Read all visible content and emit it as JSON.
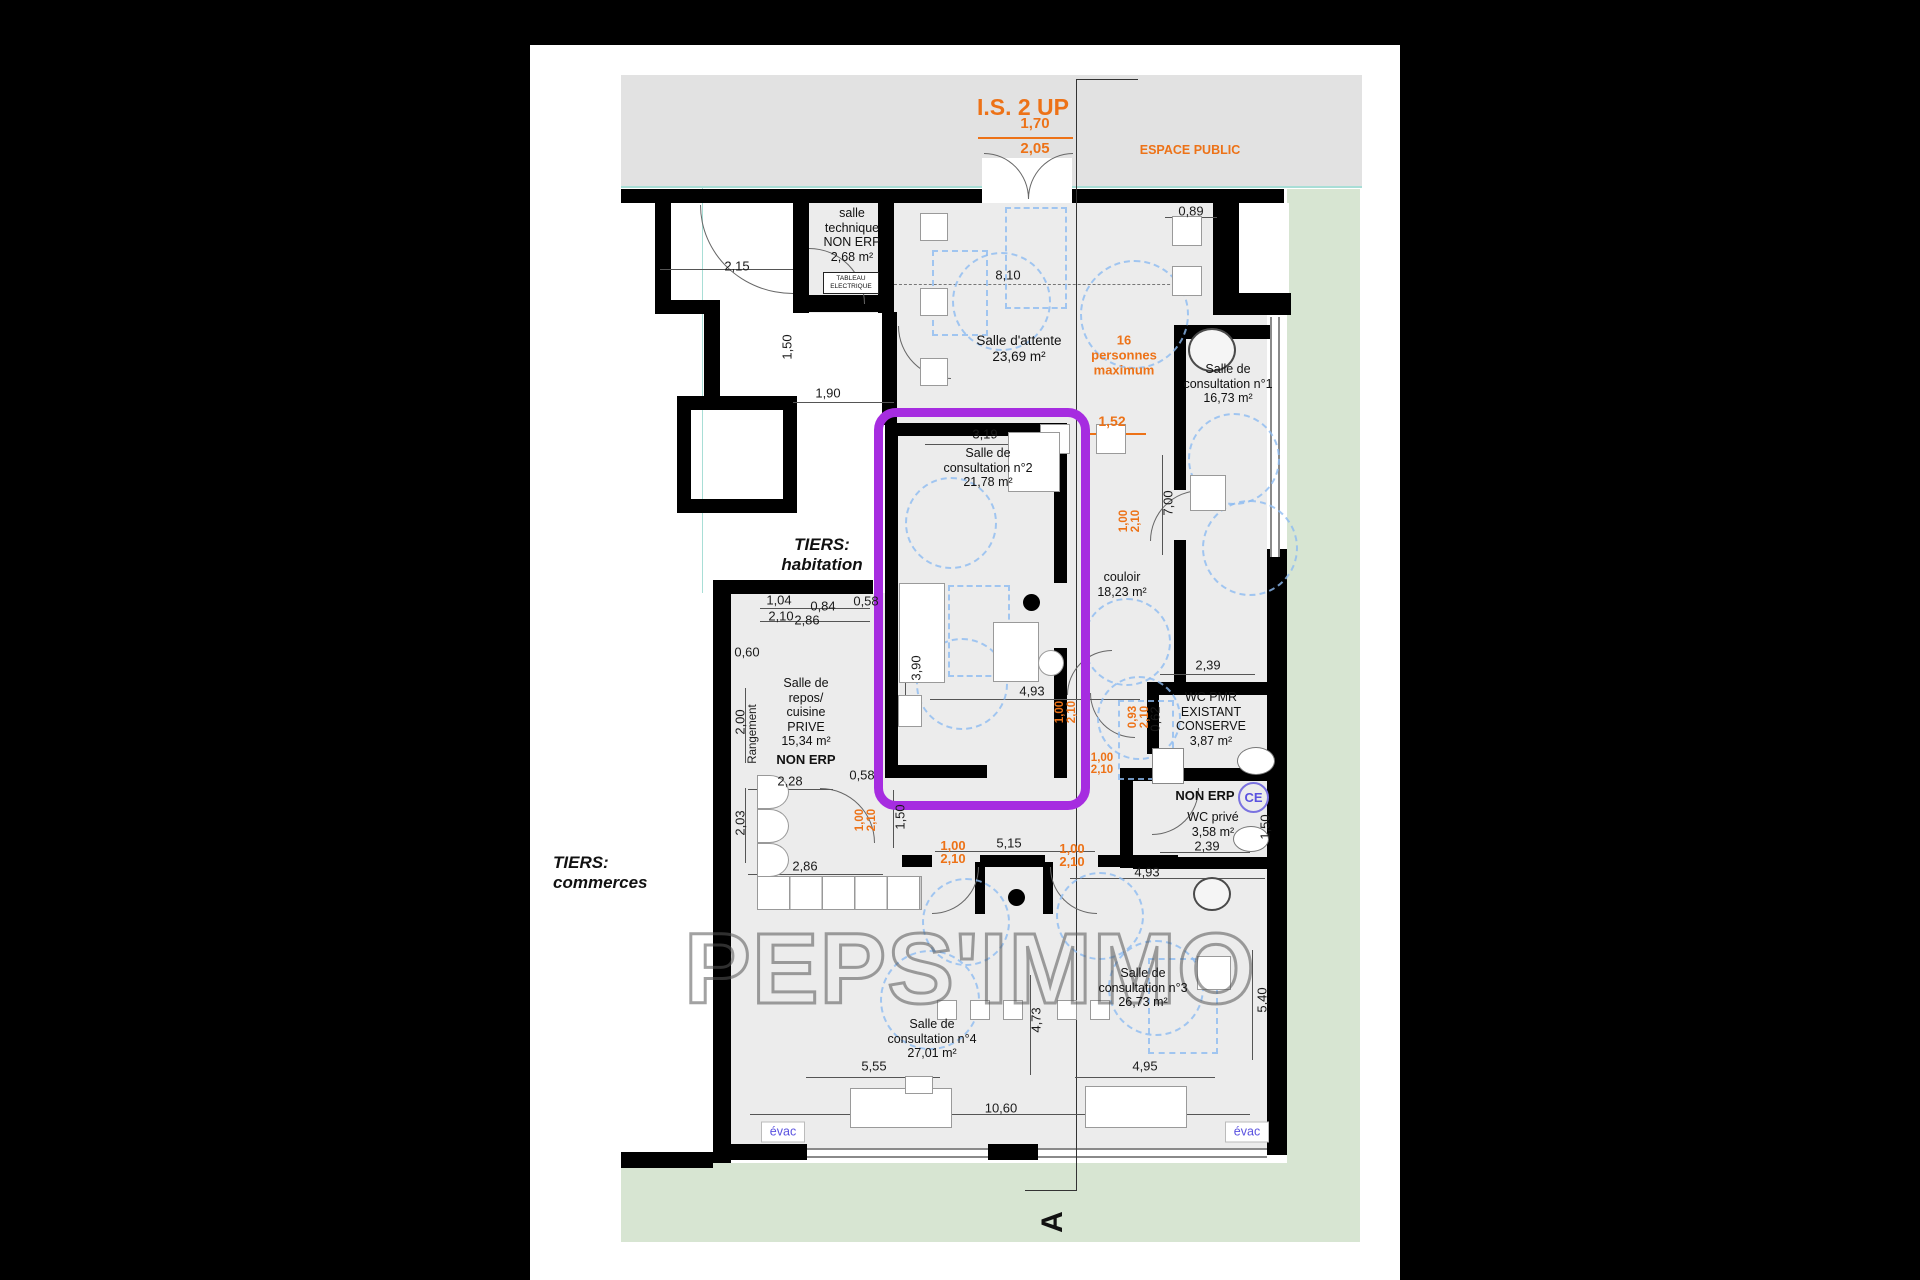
{
  "plan": {
    "watermark": "PEPS'IMMO",
    "public_space": {
      "exit_label": "I.S. 2 UP",
      "exit_width": "1,70",
      "exit_height": "2,05",
      "zone_label": "ESPACE PUBLIC"
    },
    "occupancy_note": "16\npersonnes\nmaximum",
    "section_marker": "A",
    "rooms": {
      "technique": "salle\ntechnique\nNON ERP\n2,68 m²",
      "tableau": "TABLEAU\nELECTRIQUE",
      "attente": "Salle d'attente\n23,69 m²",
      "consult1": "Salle de\nconsultation n°1\n16,73 m²",
      "consult2": "Salle de\nconsultation n°2\n21,78 m²",
      "couloir": "couloir\n18,23 m²",
      "repos": "Salle de\nrepos/\ncuisine\nPRIVE\n15,34 m²",
      "repos_non_erp": "NON ERP",
      "rangement": "Rangement",
      "wc_pmr": "WC PMR\nEXISTANT\nCONSERVE\n3,87 m²",
      "wc_prive_non_erp": "NON ERP",
      "ce_badge": "CE",
      "wc_prive": "WC privé\n3,58 m²",
      "consult3": "Salle de\nconsultation n°3\n26,73 m²",
      "consult4": "Salle de\nconsultation n°4\n27,01 m²",
      "tiers_habitation": "TIERS:\nhabitation",
      "tiers_commerces": "TIERS:\ncommerces",
      "evac": "évac"
    },
    "dims_black": [
      "0,89",
      "2,15",
      "8,10",
      "1,50",
      "1,90",
      "3,19",
      "7,00",
      "0,58",
      "1,04",
      "0,84",
      "2,10",
      "2,86",
      "0,60",
      "3,90",
      "2,39",
      "4,93",
      "0,62",
      "2,00",
      "2,28",
      "0,58",
      "1,50",
      "2,03",
      "2,86",
      "5,15",
      "4,93",
      "1,50",
      "2,39",
      "5,55",
      "4,95",
      "4,73",
      "5,40",
      "10,60"
    ],
    "dims_orange": [
      "1,70",
      "2,05",
      "1,52",
      "1,00\n2,10",
      "1,00\n2,10",
      "0,93\n2,10",
      "1,00\n2,10",
      "1,00\n2,10",
      "1,00\n2,10",
      "1,00\n2,10"
    ],
    "colors": {
      "highlight_purple": "#a62ce0",
      "dimension_orange": "#ed7217",
      "exterior_green": "#d7e5d2",
      "public_gray": "#e2e2e2",
      "clearance_blue": "#8ebcf2",
      "evac_blue": "#5a52e0"
    }
  }
}
